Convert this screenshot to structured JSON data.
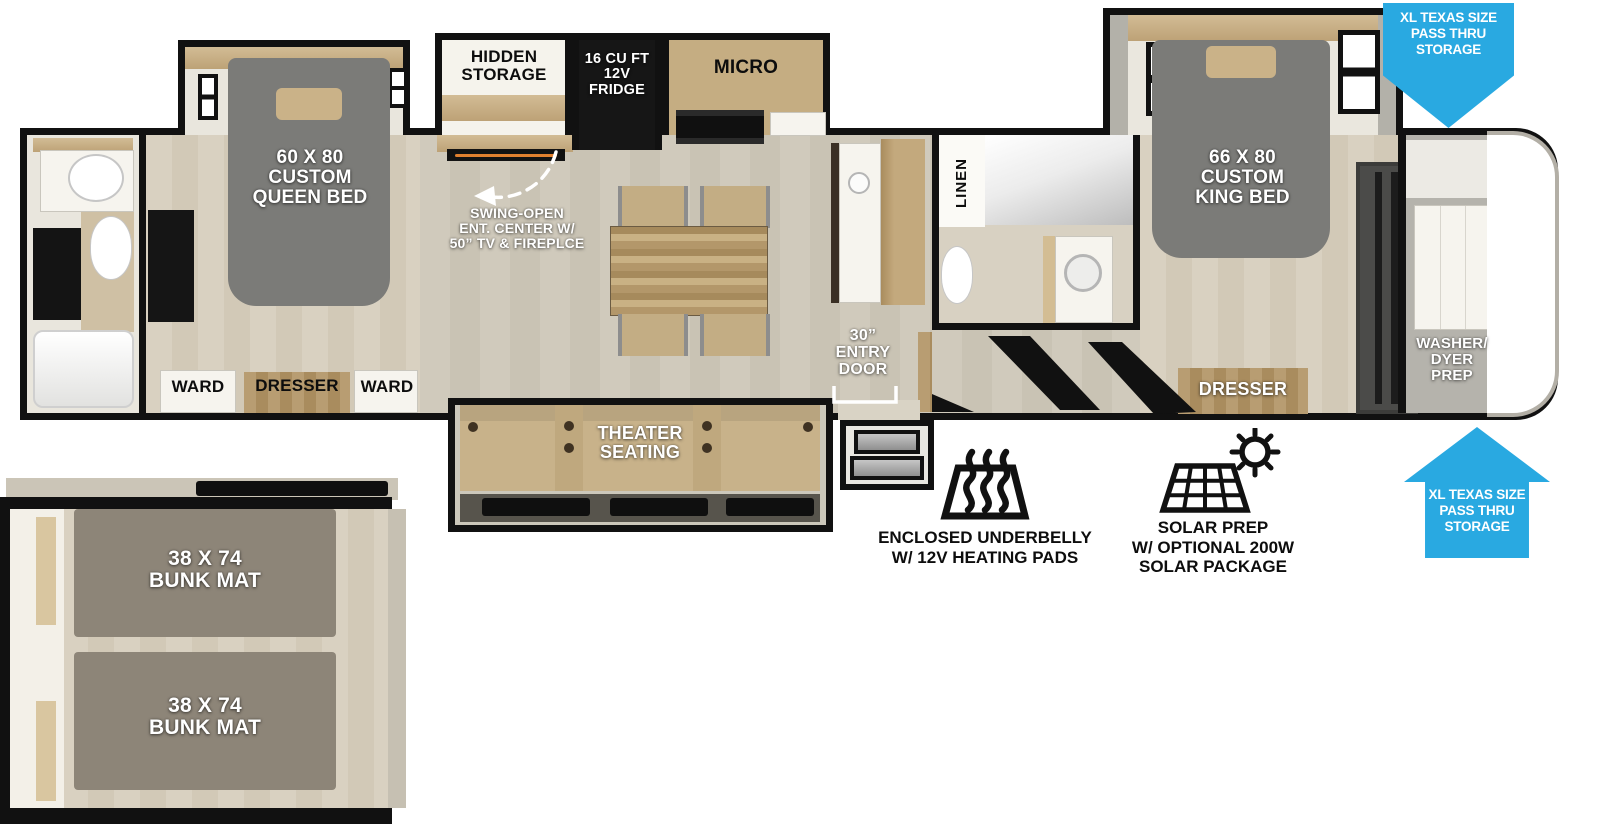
{
  "colors": {
    "accent_blue": "#29a9e1",
    "bed_gray": "#7b7b78",
    "pillow_tan": "#cab288",
    "seat_tan": "#c8b28a",
    "mattress_taupe": "#8d8578",
    "wall_black": "#111111"
  },
  "rooms": {
    "rear_bedroom": {
      "bed": "60 X 80\nCUSTOM\nQUEEN BED",
      "ward_left": "WARD",
      "dresser": "DRESSER",
      "ward_right": "WARD"
    },
    "kitchen": {
      "hidden_storage": "HIDDEN\nSTORAGE",
      "fridge": "16 CU FT\n12V\nFRIDGE",
      "micro": "MICRO"
    },
    "living": {
      "theater_seating": "THEATER\nSEATING"
    },
    "mid_bath": {
      "linen": "LINEN"
    },
    "front_bedroom": {
      "bed": "66 X 80\nCUSTOM\nKING BED",
      "dresser": "DRESSER"
    },
    "front_cap": {
      "washer": "WASHER/\nDYER\nPREP"
    },
    "bunk_room": {
      "bunk_top": "38 X 74\nBUNK MAT",
      "bunk_bottom": "38 X 74\nBUNK MAT"
    }
  },
  "annotations": {
    "ent_center": "SWING-OPEN\nENT. CENTER W/\n50” TV & FIREPLCE",
    "entry_door": "30”\nENTRY\nDOOR",
    "pass_thru_top": "XL TEXAS SIZE\nPASS THRU\nSTORAGE",
    "pass_thru_bottom": "XL TEXAS SIZE\nPASS THRU\nSTORAGE"
  },
  "features": {
    "underbelly": {
      "icon": "heat-waves-icon",
      "label": "ENCLOSED UNDERBELLY\nW/ 12V HEATING PADS"
    },
    "solar": {
      "icon": "solar-panel-icon",
      "label": "SOLAR PREP\nW/ OPTIONAL 200W\nSOLAR PACKAGE"
    }
  }
}
